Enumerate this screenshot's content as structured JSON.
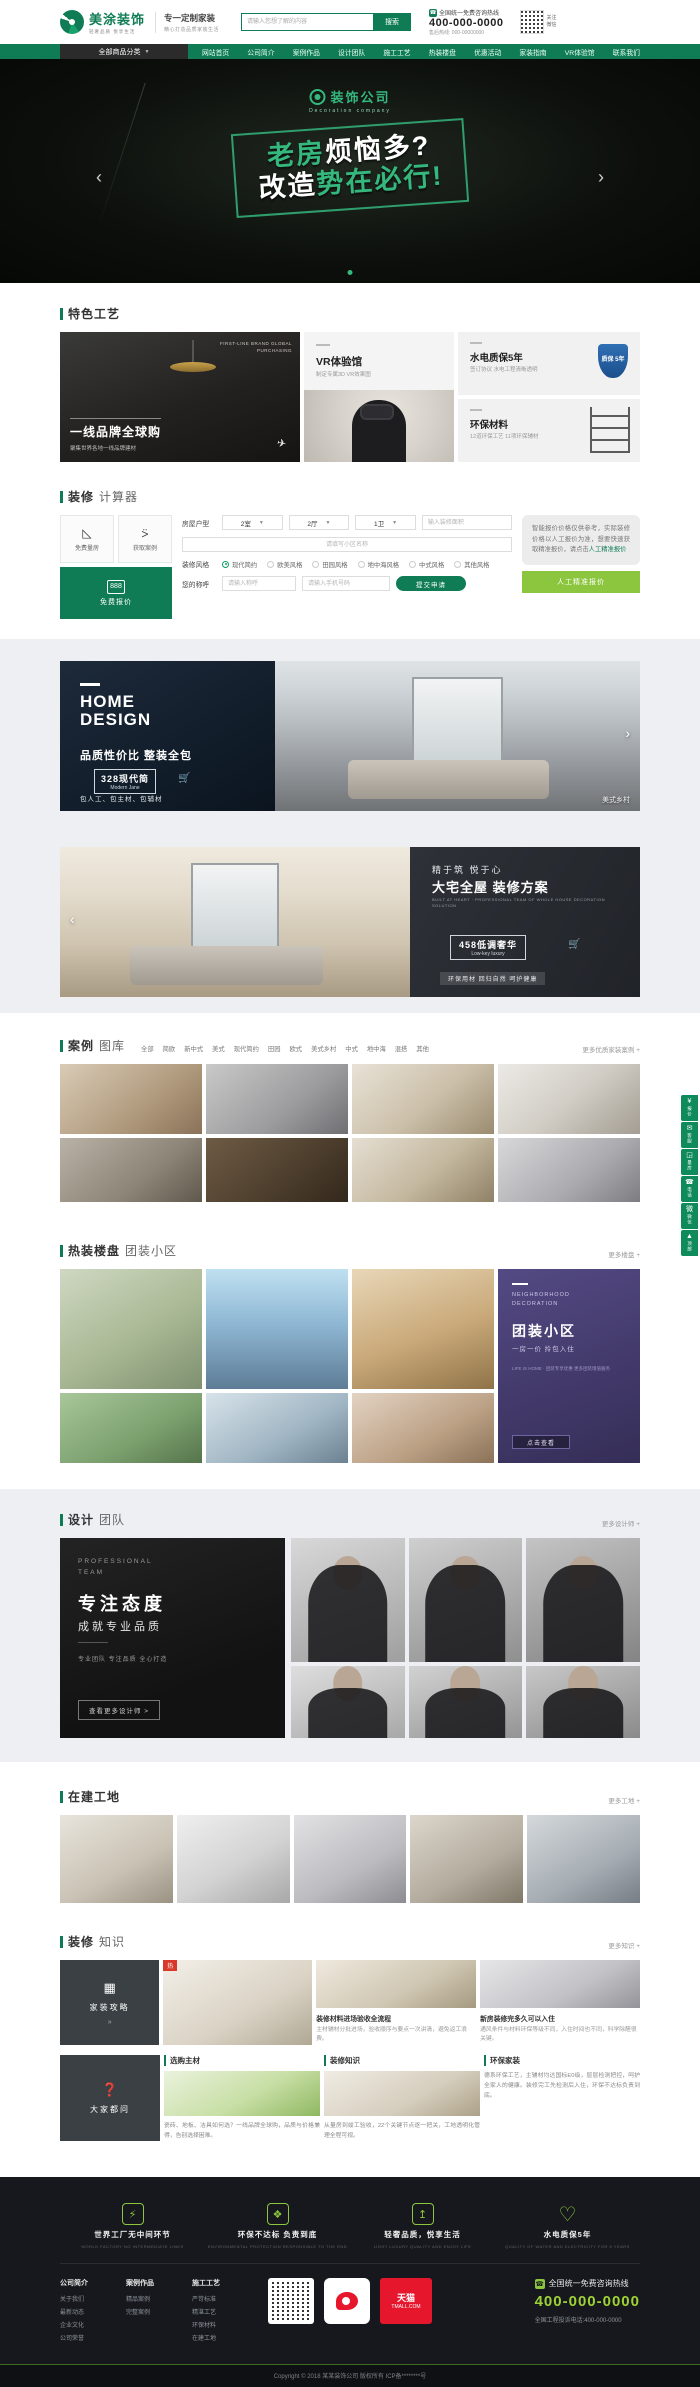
{
  "topbar": {
    "logo": {
      "name": "美涂装饰",
      "slogan": "轻奢品质 悦享生活",
      "tagline": "专一定制家装",
      "tagline_sub": "精心打造品质家装生活"
    },
    "search": {
      "placeholder": "请输入您想了解的内容",
      "button": "搜索"
    },
    "hotline": {
      "phone_icon": "☎",
      "label": "全国统一免费咨询热线",
      "number": "400-000-0000",
      "after_sale": "售后热线: 000-00000000"
    },
    "qr_label": "关注微信"
  },
  "nav": {
    "category_button": "全部商品分类",
    "chevron": "▼",
    "items": [
      "网站首页",
      "公司简介",
      "案例作品",
      "设计团队",
      "施工工艺",
      "热装楼盘",
      "优惠活动",
      "家装指南",
      "VR体验馆",
      "联系我们"
    ]
  },
  "banner": {
    "logo_text": "装饰公司",
    "logo_en": "Decoration company",
    "line1_green": "老房",
    "line1_white": "烦恼多?",
    "line2_white": "改造",
    "line2_green": "势在必行!",
    "prev": "‹",
    "next": "›"
  },
  "features": {
    "title": "特色工艺",
    "brand": {
      "en1": "FIRST-LINE BRAND GLOBAL",
      "en2": "PURCHASING",
      "title": "一线品牌全球购",
      "sub": "聚集世界各地一线品牌建材",
      "plane": "✈"
    },
    "vr": {
      "title": "VR体验馆",
      "sub": "制定专属3D VR效果图"
    },
    "water": {
      "title": "水电质保5年",
      "sub": "签订协议 水电工程清晰透明",
      "badge": "质保 5年"
    },
    "eco": {
      "title": "环保材料",
      "sub": "12道环保工艺 11项环保辅材"
    }
  },
  "calculator": {
    "title_1": "装修",
    "title_2": "计算器",
    "quick1": "免费量房",
    "quick2": "获取案例",
    "free_quote": "免费报价",
    "calc_glyph": "888",
    "form": {
      "row1_label": "房屋户型",
      "select_room": "2室",
      "select_hall": "2厅",
      "select_bath": "1卫",
      "select_arrow": "▼",
      "area_placeholder": "输入装修面积",
      "community_placeholder": "请填写小区名称",
      "style_label": "装修风格",
      "styles": [
        "现代简约",
        "欧美风格",
        "田园风格",
        "地中海风格",
        "中式风格",
        "其他风格"
      ],
      "name_label": "您的称呼",
      "name_placeholder": "请输入称呼",
      "phone_placeholder": "请输入手机号码",
      "submit": "提交申请"
    },
    "tip_text": "智能报价价格仅供参考，实际装修价格以人工报价为准，想要快速获取精准报价，请点击",
    "tip_link": "人工精准报价",
    "manual_button": "人工精准报价"
  },
  "promo1": {
    "en1": "HOME",
    "en2": "DESIGN",
    "title": "品质性价比 整装全包",
    "badge": "328现代简",
    "badge_en": "Modern Jane",
    "cart": "🛒",
    "note": "包人工、包主材、包辅材",
    "corner": "美式乡村",
    "next": "›"
  },
  "promo2": {
    "prev": "‹",
    "line1": "精于筑 悦于心",
    "line2": "大宅全屋 装修方案",
    "line3": "BUILT AT HEART · PROFESSIONAL TEAM OF WHOLE HOUSE DECORATION SOLUTION",
    "badge": "458低调奢华",
    "badge_en": "Low-key luxury",
    "cart": "🛒",
    "tag": "环保用材 回归自然 呵护健康"
  },
  "cases": {
    "title_1": "案例",
    "title_2": "图库",
    "tabs": [
      "全部",
      "简欧",
      "新中式",
      "美式",
      "现代简约",
      "田园",
      "欧式",
      "美式乡村",
      "中式",
      "地中海",
      "混搭",
      "其他"
    ],
    "more": "更多优质家装案例 +"
  },
  "estates": {
    "title_1": "热装楼盘",
    "title_2": "团装小区",
    "more": "更多楼盘 +",
    "card": {
      "en1": "NEIGHBORHOOD",
      "en2": "DECORATION",
      "title": "团装小区",
      "sub": "一房一价 拎包入住",
      "desc": "LIFE IS HOME · 团装专享优惠 更多团装增值服务",
      "button": "点击查看"
    }
  },
  "designers": {
    "title_1": "设计",
    "title_2": "团队",
    "more": "更多设计师 +",
    "promo": {
      "en1": "PROFESSIONAL",
      "en2": "TEAM",
      "t1": "专注态度",
      "t2": "成就专业品质",
      "desc": "专业团队 专注品质 全心打造",
      "link": "查看更多设计师 >"
    }
  },
  "sites": {
    "title_1": "在建工地",
    "more": "更多工地 +"
  },
  "knowledge": {
    "title_1": "装修",
    "title_2": "知识",
    "more": "更多知识 +",
    "tab1": "家装攻略",
    "tab1_icon": "▦",
    "tab1_arrow": "»",
    "tab2": "大家都问",
    "tab2_icon": "❓",
    "img_tag": "热",
    "article1": {
      "title": "装修材料进场验收全流程",
      "desc": "主材辅材分批进场，验收顺序与要点一次讲清，避免返工浪费。"
    },
    "article2": {
      "title": "新房装修完多久可以入住",
      "desc": "通风条件与材料环保等级不同，入住时间也不同，科学除醛很关键。"
    },
    "col1": {
      "header": "选购主材",
      "text": "瓷砖、地板、洁具如何选？一线品牌全球购，品质与价格兼得，告别选择困难。"
    },
    "col2": {
      "header": "装修知识",
      "text": "从量房到竣工验收，22个关键节点逐一把关，工地透明化管理全程可视。"
    },
    "col3": {
      "header": "环保家装",
      "text": "德系环保工艺，主辅材均达国标E0级，层层检测把控，呵护全家人的健康。装修完工先检测后入住，环保不达标负责到底。"
    }
  },
  "footer": {
    "features": [
      {
        "icon": "⚡",
        "title": "世界工厂无中间环节",
        "en": "WORLD FACTORY NO INTERMEDIATE LINKS"
      },
      {
        "icon": "❖",
        "title": "环保不达标 负责到底",
        "en": "ENVIRONMENTAL PROTECTION RESPONSIBLE TO THE END"
      },
      {
        "icon": "↥",
        "title": "轻奢品质，悦享生活",
        "en": "LIGHT LUXURY QUALITY AND ENJOY LIFE"
      },
      {
        "icon": "♡",
        "title": "水电质保5年",
        "en": "QUALITY OF WATER AND ELECTRICITY FOR 5 YEARS"
      }
    ],
    "col1": {
      "head": "公司简介",
      "links": [
        "关于我们",
        "最新动态",
        "企业文化",
        "公司荣誉"
      ]
    },
    "col2": {
      "head": "案例作品",
      "links": [
        "精品案例",
        "完整案例"
      ]
    },
    "col3": {
      "head": "施工工艺",
      "links": [
        "严苛标准",
        "精湛工艺",
        "环保材料",
        "在建工地"
      ]
    },
    "tmall_1": "天猫",
    "tmall_2": "TMALL.COM",
    "phone": {
      "icon": "☎",
      "label": "全国统一免费咨询热线",
      "number": "400-000-0000",
      "complaint": "全国工程投诉电话:400-000-0000"
    },
    "copyright": "Copyright © 2018 某某装饰公司 版权所有 ICP备********号"
  },
  "floatbar": [
    {
      "icon": "¥",
      "label": "报价"
    },
    {
      "icon": "✉",
      "label": "客服"
    },
    {
      "icon": "◲",
      "label": "量房"
    },
    {
      "icon": "☎",
      "label": "电话"
    },
    {
      "icon": "微",
      "label": "微信"
    },
    {
      "icon": "▲",
      "label": "顶部"
    }
  ]
}
